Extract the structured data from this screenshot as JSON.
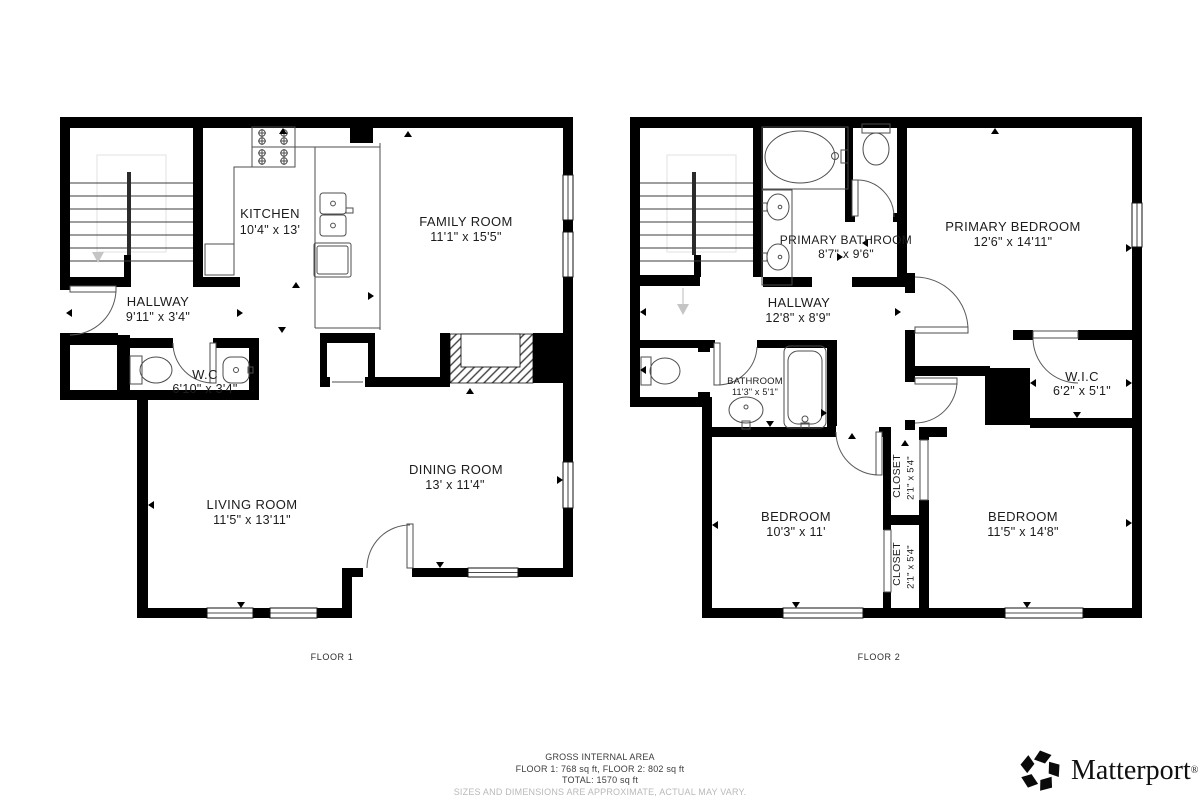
{
  "floor1": {
    "label": "FLOOR 1",
    "rooms": {
      "kitchen": {
        "name": "KITCHEN",
        "dims": "10'4\" x 13'"
      },
      "family": {
        "name": "FAMILY ROOM",
        "dims": "11'1\" x 15'5\""
      },
      "hallway": {
        "name": "HALLWAY",
        "dims": "9'11\" x 3'4\""
      },
      "wc": {
        "name": "W.C",
        "dims": "6'10\" x 3'4\""
      },
      "living": {
        "name": "LIVING ROOM",
        "dims": "11'5\" x 13'11\""
      },
      "dining": {
        "name": "DINING ROOM",
        "dims": "13' x 11'4\""
      }
    }
  },
  "floor2": {
    "label": "FLOOR 2",
    "rooms": {
      "primary_bathroom": {
        "name": "PRIMARY BATHROOM",
        "dims": "8'7\" x 9'6\""
      },
      "primary_bedroom": {
        "name": "PRIMARY BEDROOM",
        "dims": "12'6\" x 14'11\""
      },
      "hallway": {
        "name": "HALLWAY",
        "dims": "12'8\" x 8'9\""
      },
      "bathroom": {
        "name": "BATHROOM",
        "dims": "11'3\" x 5'1\""
      },
      "wic": {
        "name": "W.I.C",
        "dims": "6'2\" x 5'1\""
      },
      "bedroom_left": {
        "name": "BEDROOM",
        "dims": "10'3\" x 11'"
      },
      "bedroom_right": {
        "name": "BEDROOM",
        "dims": "11'5\" x 14'8\""
      },
      "closet_top": {
        "name": "CLOSET",
        "dims": "2'1\" x 5'4\""
      },
      "closet_bottom": {
        "name": "CLOSET",
        "dims": "2'1\" x 5'4\""
      }
    }
  },
  "footer": {
    "title": "GROSS INTERNAL AREA",
    "line1": "FLOOR 1: 768 sq ft, FLOOR 2: 802 sq ft",
    "line2": "TOTAL: 1570 sq ft",
    "disclaimer": "SIZES AND DIMENSIONS ARE APPROXIMATE, ACTUAL MAY VARY."
  },
  "brand": {
    "wordmark": "Matterport",
    "registered": "®"
  },
  "colors": {
    "wall": "#000000",
    "fixture_line": "#4d4d4d",
    "faint_line": "#e2e2e2",
    "stairs_arrow": "#c5c5c5",
    "label_text": "#1c1c1c",
    "muted_text": "#b9b9b9",
    "background": "#ffffff"
  }
}
